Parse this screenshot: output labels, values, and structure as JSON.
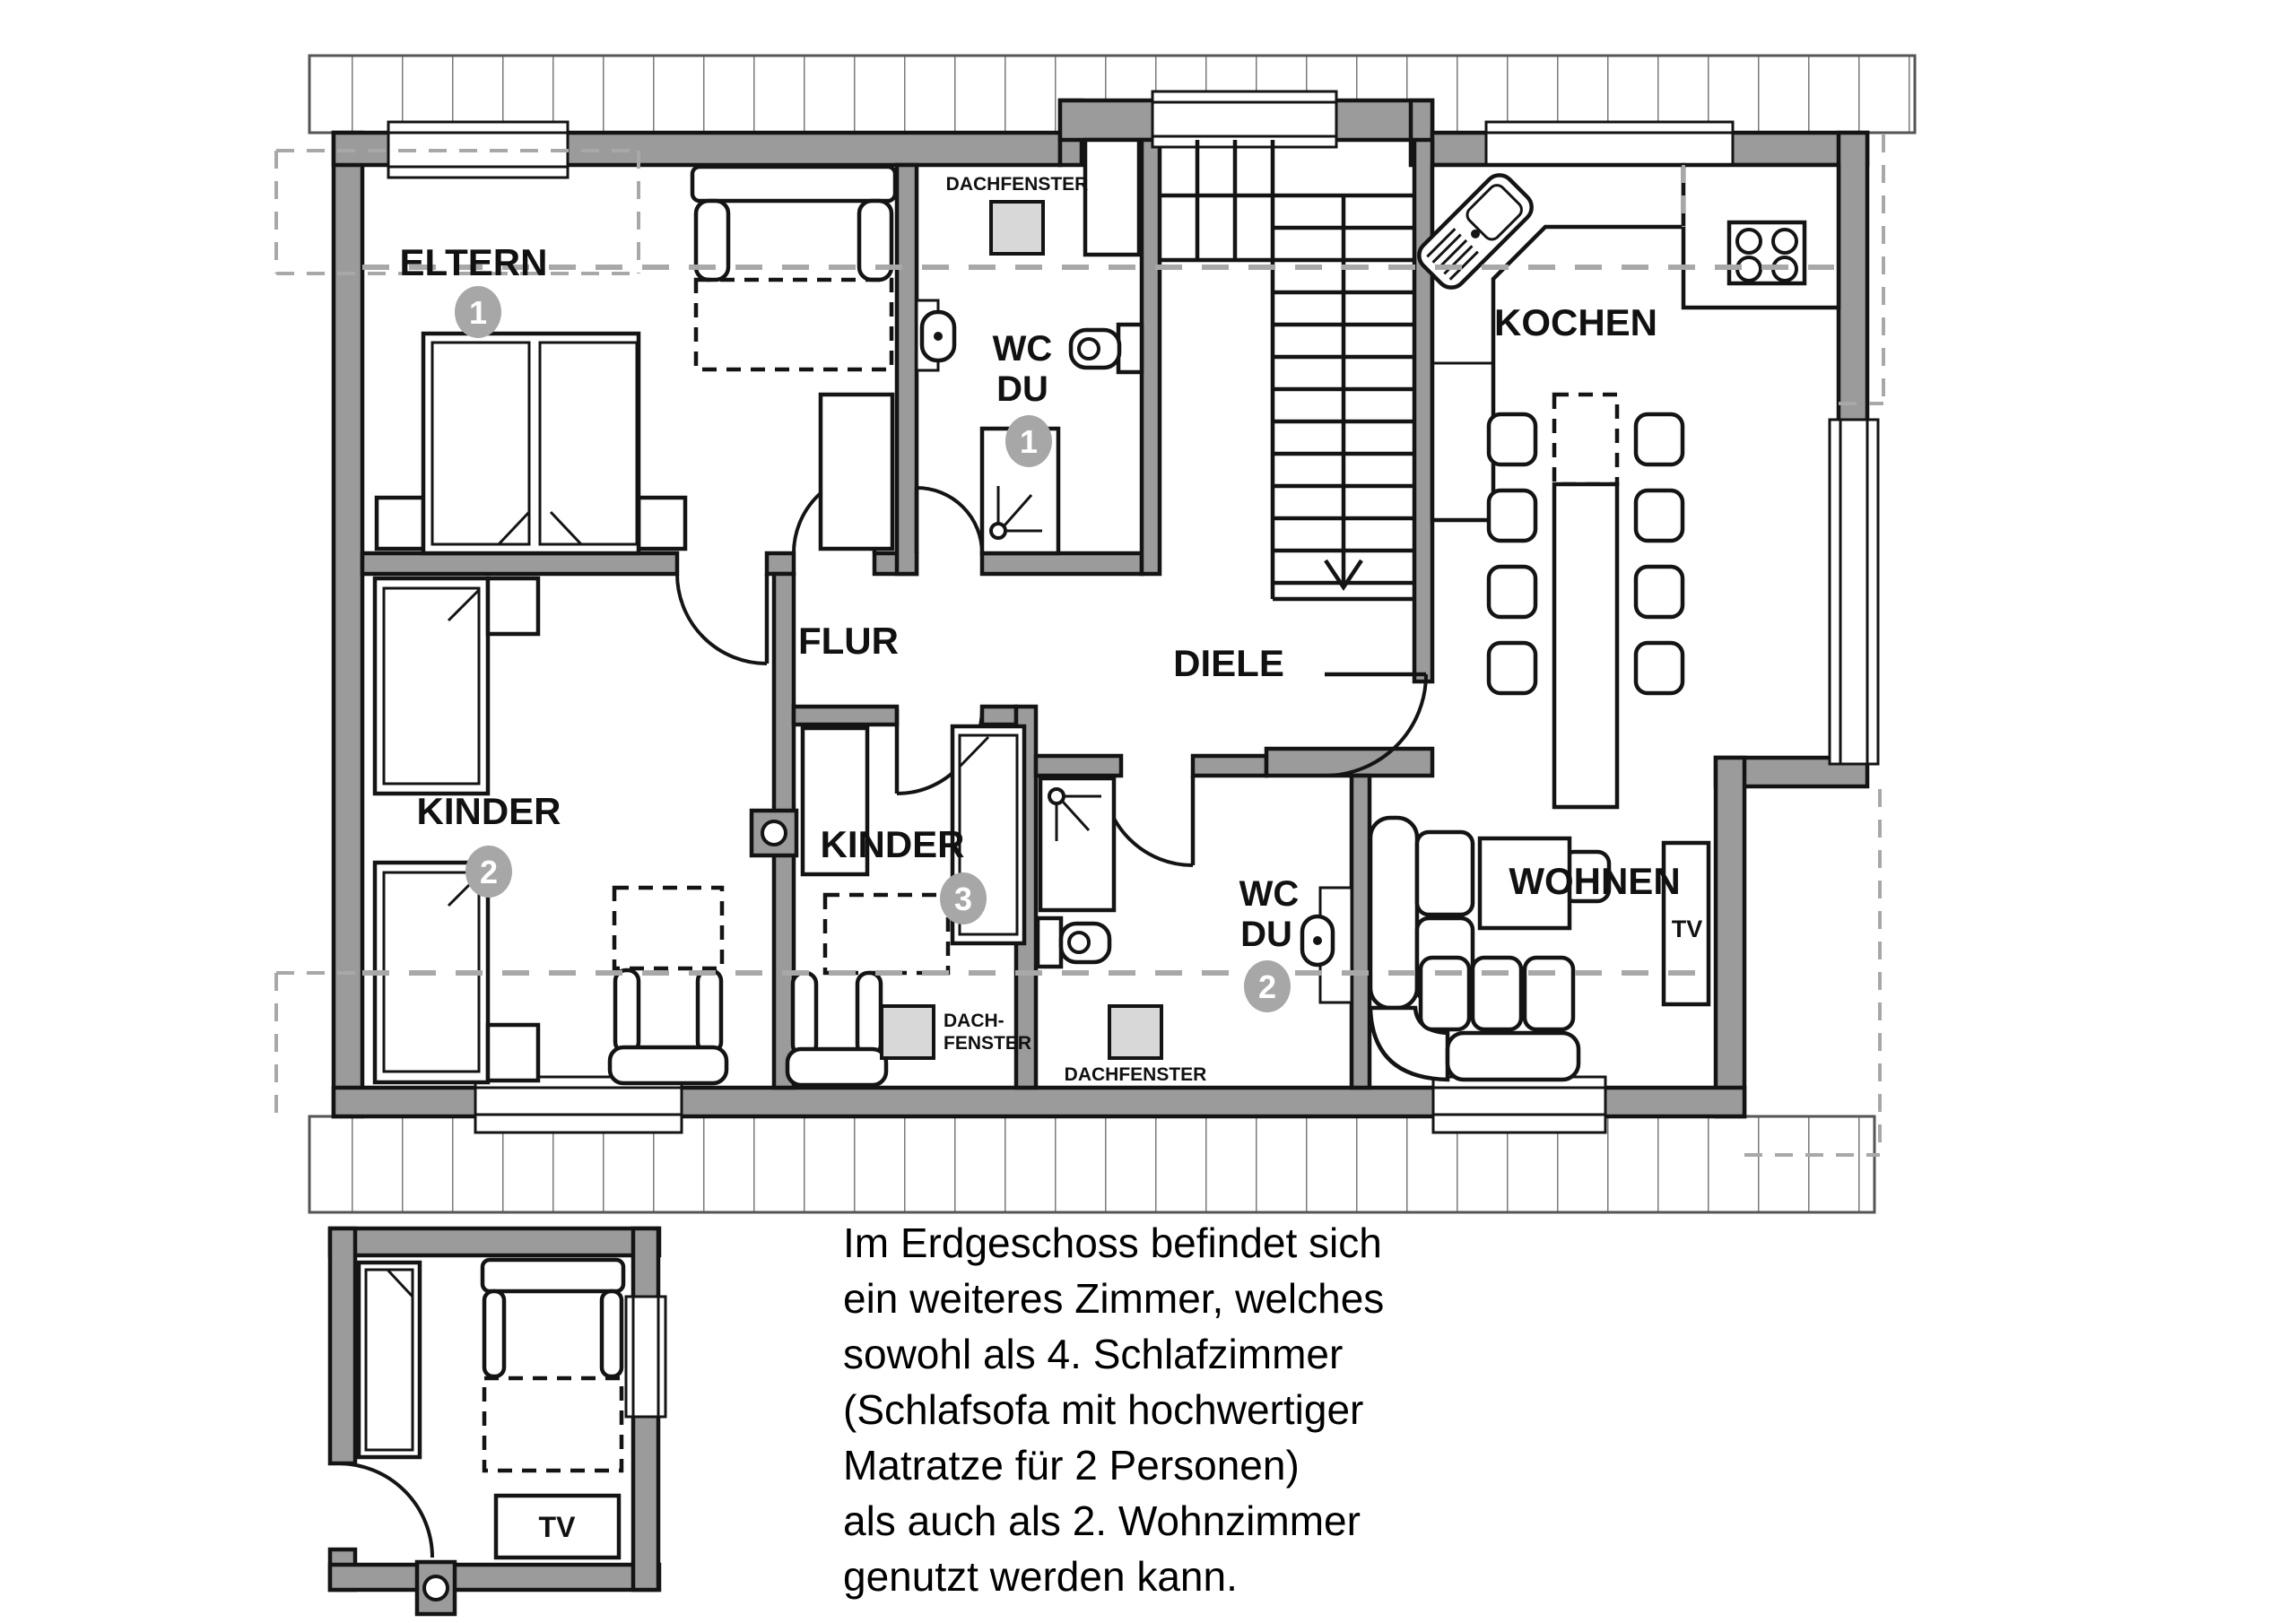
{
  "rooms": {
    "eltern": {
      "name": "ELTERN",
      "badge": "1"
    },
    "wc_du_1": {
      "line1": "WC",
      "line2": "DU",
      "badge": "1"
    },
    "flur": {
      "name": "FLUR"
    },
    "diele": {
      "name": "DIELE"
    },
    "kochen": {
      "name": "KOCHEN"
    },
    "kinder2": {
      "name": "KINDER",
      "badge": "2"
    },
    "kinder3": {
      "name": "KINDER",
      "badge": "3"
    },
    "wc_du_2": {
      "line1": "WC",
      "line2": "DU",
      "badge": "2"
    },
    "wohnen": {
      "name": "WOHNEN"
    }
  },
  "labels": {
    "skylight_wc1": "DACHFENSTER",
    "skylight_kinder3_line1": "DACH-",
    "skylight_kinder3_line2": "FENSTER",
    "skylight_wc2": "DACHFENSTER",
    "tv_wohnen": "TV",
    "tv_eg": "TV"
  },
  "description": {
    "lines": [
      "Im Erdgeschoss befindet sich",
      "ein weiteres Zimmer, welches",
      "sowohl als 4. Schlafzimmer",
      "(Schlafsofa mit hochwertiger",
      "Matratze für 2 Personen)",
      "als auch als 2. Wohnzimmer",
      "genutzt werden kann."
    ]
  },
  "colors": {
    "wall": "#9b9b9b",
    "skylight": "#d8d8d8",
    "badge": "#a7a7a7",
    "dashed_gray": "#a8a8a8",
    "ink": "#141414"
  }
}
